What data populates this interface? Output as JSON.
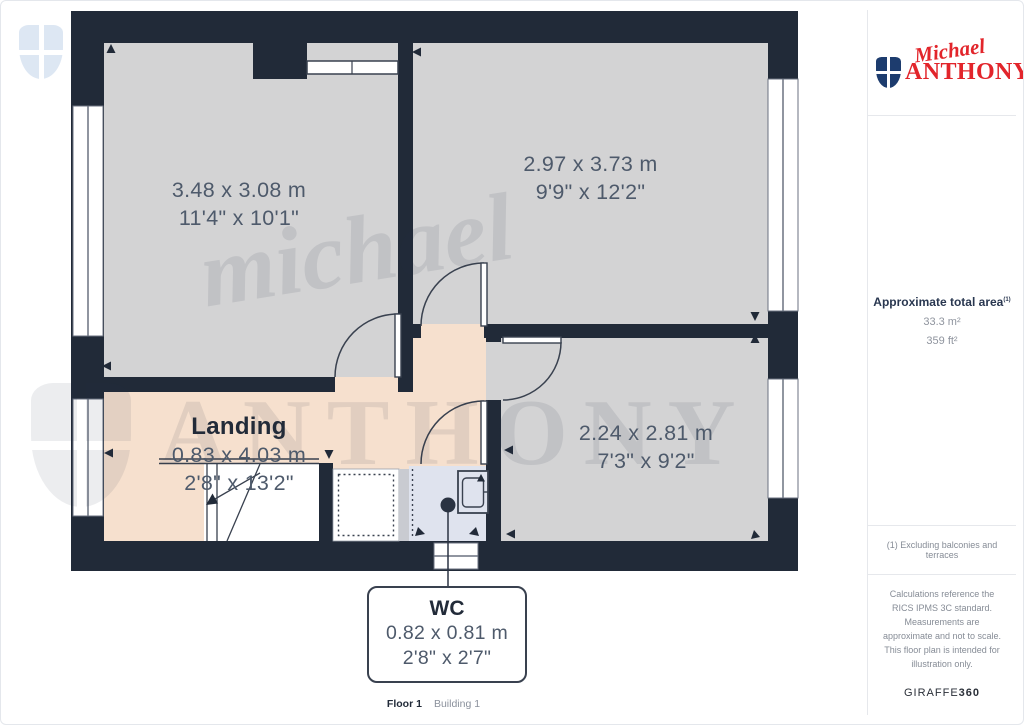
{
  "colors": {
    "wall": "#212a38",
    "room_fill": "#d3d3d4",
    "landing_fill": "#f6e0ce",
    "wc_fill": "#dfe3ee",
    "brand_red": "#e2252b",
    "brand_navy": "#1d3c6e",
    "label_dark": "#222b39",
    "label_dim": "#4e5a6b"
  },
  "branding": {
    "logo_script": "Michael",
    "logo_caps": "ANTHONY"
  },
  "watermark": {
    "script": "michael",
    "caps": "ANTHONY"
  },
  "sidebar": {
    "area_title": "Approximate total area",
    "area_note_ref": "(1)",
    "area_metric": "33.3 m²",
    "area_imperial": "359 ft²",
    "footnote": "(1) Excluding balconies and terraces",
    "disclaimer": "Calculations reference the RICS IPMS 3C standard. Measurements are approximate and not to scale. This floor plan is intended for illustration only.",
    "brand_word": "GIRAFFE",
    "brand_number": "360"
  },
  "plan": {
    "rooms": [
      {
        "id": "room-top-left",
        "metric": "3.48 x 3.08 m",
        "imperial": "11'4\" x 10'1\""
      },
      {
        "id": "room-top-right",
        "metric": "2.97 x 3.73 m",
        "imperial": "9'9\" x 12'2\""
      },
      {
        "id": "room-bottom-right",
        "metric": "2.24 x 2.81 m",
        "imperial": "7'3\" x 9'2\""
      },
      {
        "id": "landing",
        "name": "Landing",
        "metric": "0.83 x 4.03 m",
        "imperial": "2'8\" x 13'2\""
      },
      {
        "id": "wc",
        "name": "WC",
        "metric": "0.82 x 0.81 m",
        "imperial": "2'8\" x 2'7\""
      }
    ]
  },
  "footer": {
    "floor": "Floor 1",
    "building": "Building 1"
  }
}
